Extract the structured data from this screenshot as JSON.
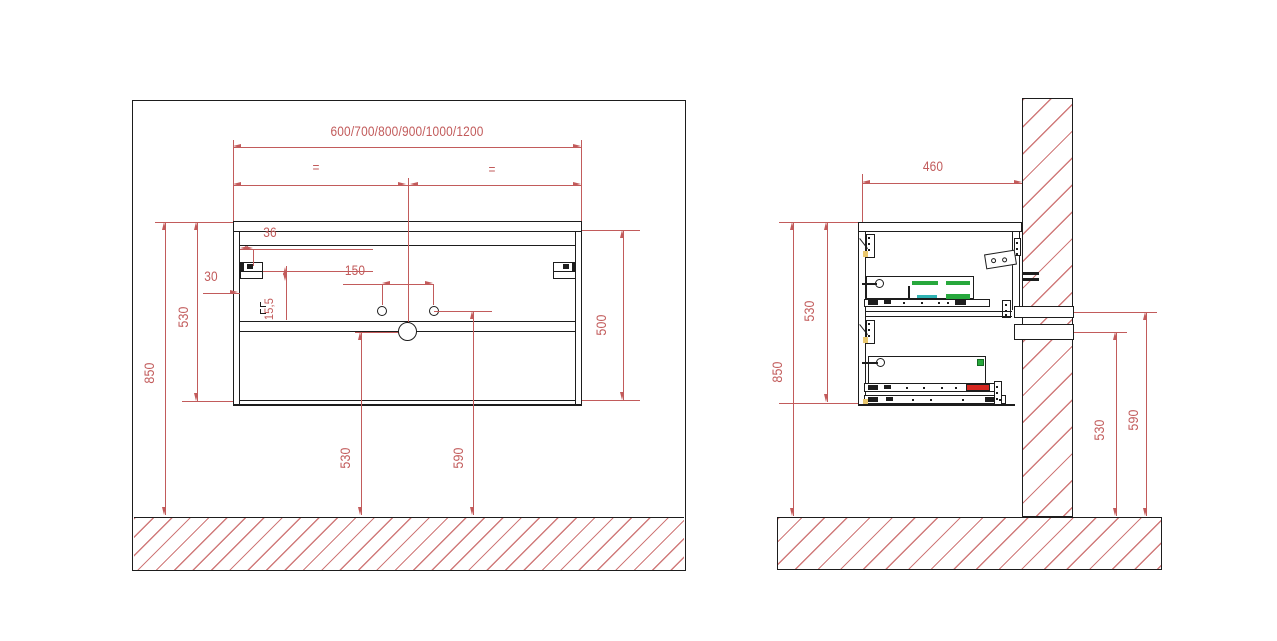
{
  "front_view": {
    "width_series": "600/700/800/900/1000/1200",
    "equal_mark_left": "=",
    "equal_mark_right": "=",
    "dim_bracket_inset": "36",
    "dim_side_offset": "30",
    "dim_bracket_drop": "15,5",
    "dim_hole_spacing": "150",
    "dim_cabinet_height": "530",
    "dim_mount_height": "850",
    "dim_inner_height": "500",
    "dim_drain_height": "530",
    "dim_outlet_height": "590"
  },
  "side_view": {
    "dim_depth": "460",
    "dim_mount_height": "850",
    "dim_cabinet_height": "530",
    "dim_lower_pipe_height": "530",
    "dim_upper_pipe_height": "590"
  },
  "colors": {
    "dimension_red": "#c25b5b",
    "hatch_red": "#d07a7a",
    "line_black": "#1d1d1d",
    "slide_green": "#27a83c",
    "slide_cyan": "#2fb3b3",
    "slide_red": "#d5261f",
    "fitting_yellow": "#e9c76d"
  }
}
